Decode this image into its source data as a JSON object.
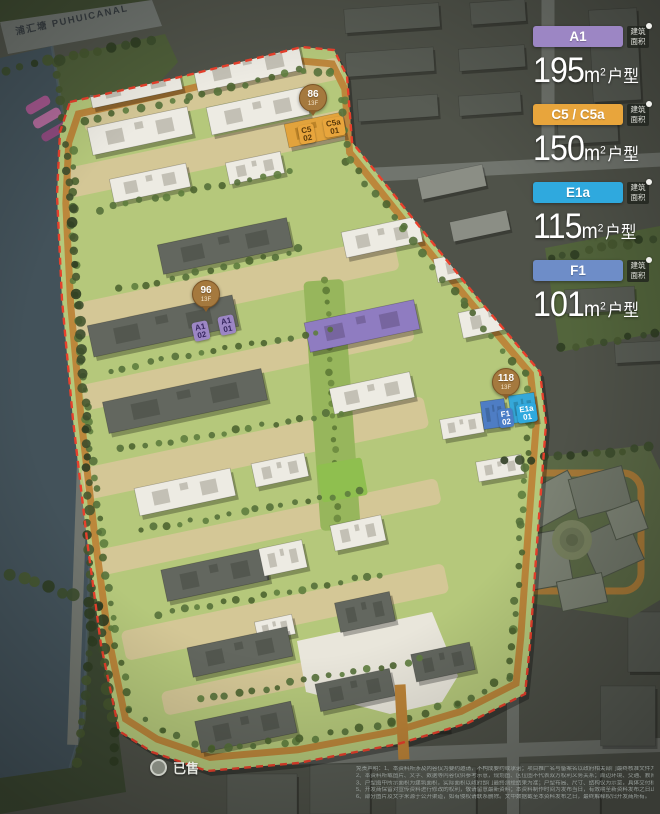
{
  "canal": {
    "label": "浦汇塘 PUHUICANAL"
  },
  "legend": {
    "area_badge_text": "建筑面积",
    "unit_m": "m",
    "unit_exp": "2",
    "unit_suffix": "户型",
    "entries": [
      {
        "code": "A1",
        "value": "195",
        "color": "#9c86c4"
      },
      {
        "code": "C5 / C5a",
        "value": "150",
        "color": "#e8a53c"
      },
      {
        "code": "E1a",
        "value": "115",
        "color": "#2fa9de"
      },
      {
        "code": "F1",
        "value": "101",
        "color": "#6e8dc8"
      }
    ]
  },
  "markers": [
    {
      "number": "86",
      "floor": "13F",
      "x": 313,
      "y": 100,
      "tags": [
        {
          "label": "C5",
          "num": "02",
          "x": 307,
          "y": 134,
          "rot": -10,
          "bg": "#e8a53c",
          "fg": "#59390a"
        },
        {
          "label": "C5a",
          "num": "01",
          "x": 334,
          "y": 127,
          "rot": -10,
          "bg": "#e8a53c",
          "fg": "#59390a"
        }
      ]
    },
    {
      "number": "96",
      "floor": "13F",
      "x": 206,
      "y": 296,
      "tags": [
        {
          "label": "A1",
          "num": "02",
          "x": 201,
          "y": 331,
          "rot": -12,
          "bg": "#9c86c4",
          "fg": "#35255e"
        },
        {
          "label": "A1",
          "num": "01",
          "x": 227,
          "y": 325,
          "rot": -12,
          "bg": "#9c86c4",
          "fg": "#35255e"
        }
      ]
    },
    {
      "number": "118",
      "floor": "13F",
      "x": 506,
      "y": 384,
      "tags": [
        {
          "label": "F1",
          "num": "02",
          "x": 506,
          "y": 418,
          "rot": -8,
          "bg": "#4a7dc6",
          "fg": "#ffffff"
        },
        {
          "label": "E1a",
          "num": "01",
          "x": 527,
          "y": 413,
          "rot": -8,
          "bg": "#2fa9de",
          "fg": "#ffffff"
        }
      ]
    }
  ],
  "sold": {
    "label": "已售"
  },
  "disclaimer": {
    "lines": [
      "免责声明：1、本资料所涉及内容仅为要约邀请，不构成要约或承诺；项目推广名与备案名以政府相关部门最终核准文件为准，买卖双方权利义务以双方签署的《商品房预售合同》及附件等协议为准。",
      "2、本资料所载图片、文字、数据等内容仅供参考示意，规划图、区位图不代表双方权利义务关系；周边环境、交通、教育、商业等配套信息仅作参考，不作为开发商的承诺或保证，敬请留意。",
      "3、户型图中所示面积为建筑面积，实际面积以政府部门最终测绘结果为准；户型布局、尺寸、结构仅为示意，具体交付标准以合同约定为准。4、本资料对项目周边环境的介绍旨在提供相关信息，不代表对此作出承诺。",
      "5、开发商保留对宣传资料进行修改的权利，敬请留意最新资料；本资料制作时间为发布当日，有效期至新资料发布之日止；相关内容不排除因政府规划、规定及开发商未能控制的原因而发生变化。",
      "6、部分图片及文字来源于公开渠道，如有侵权请联系删除。文中数据截至本资料发布之日，最终解释权归开发商所有。"
    ]
  },
  "map": {
    "bg": "#4f5249",
    "canal": {
      "pts": [
        [
          0,
          58
        ],
        [
          52,
          46
        ],
        [
          70,
          160
        ],
        [
          82,
          330
        ],
        [
          90,
          560
        ],
        [
          84,
          720
        ],
        [
          70,
          768
        ],
        [
          0,
          778
        ]
      ],
      "fill": "#43525a"
    },
    "top_road": {
      "pts": [
        [
          0,
          22
        ],
        [
          152,
          0
        ],
        [
          162,
          26
        ],
        [
          8,
          54
        ]
      ],
      "fill": "#6e736e"
    },
    "roads": [
      {
        "x": 500,
        "y": 168,
        "w": 330,
        "h": 14,
        "rot": -3
      },
      {
        "x": 548,
        "y": 82,
        "w": 13,
        "h": 172,
        "rot": 0
      },
      {
        "x": 430,
        "y": 753,
        "w": 470,
        "h": 14,
        "rot": -2
      },
      {
        "x": 513,
        "y": 722,
        "w": 12,
        "h": 190,
        "rot": 0
      },
      {
        "x": 84,
        "y": 420,
        "w": 11,
        "h": 650,
        "rot": 2
      }
    ],
    "road_fill": "#71756e",
    "greens": [
      {
        "pts": [
          [
            0,
            0
          ],
          [
            150,
            0
          ],
          [
            0,
            24
          ]
        ],
        "fill": "#3e4a31"
      },
      {
        "pts": [
          [
            40,
            62
          ],
          [
            165,
            34
          ],
          [
            178,
            62
          ],
          [
            96,
            152
          ],
          [
            56,
            152
          ]
        ],
        "fill": "#4e5e39"
      },
      {
        "pts": [
          [
            0,
            540
          ],
          [
            96,
            562
          ],
          [
            126,
            792
          ],
          [
            0,
            814
          ]
        ],
        "fill": "#3c4832"
      },
      {
        "pts": [
          [
            545,
            248
          ],
          [
            660,
            226
          ],
          [
            660,
            332
          ],
          [
            560,
            352
          ]
        ],
        "fill": "#53653c"
      }
    ],
    "pink_beds": [
      {
        "x": 38,
        "y": 105,
        "w": 26,
        "h": 10,
        "rot": -30,
        "fill": "#a2568c"
      },
      {
        "x": 47,
        "y": 118,
        "w": 30,
        "h": 10,
        "rot": -30,
        "fill": "#b06a9a"
      },
      {
        "x": 56,
        "y": 131,
        "w": 32,
        "h": 9,
        "rot": -30,
        "fill": "#8e4a7e"
      }
    ],
    "blocks_fill": "#585c54",
    "blocks": [
      {
        "x": 392,
        "y": 18,
        "w": 95,
        "h": 24,
        "rot": -4
      },
      {
        "x": 498,
        "y": 12,
        "w": 55,
        "h": 22,
        "rot": -4
      },
      {
        "x": 390,
        "y": 62,
        "w": 88,
        "h": 24,
        "rot": -4
      },
      {
        "x": 492,
        "y": 58,
        "w": 66,
        "h": 22,
        "rot": -4
      },
      {
        "x": 615,
        "y": 55,
        "w": 48,
        "h": 92,
        "rot": -3
      },
      {
        "x": 398,
        "y": 108,
        "w": 80,
        "h": 22,
        "rot": -4
      },
      {
        "x": 490,
        "y": 104,
        "w": 62,
        "h": 20,
        "rot": -4
      },
      {
        "x": 588,
        "y": 132,
        "w": 60,
        "h": 22,
        "rot": -3
      },
      {
        "x": 452,
        "y": 182,
        "w": 66,
        "h": 22,
        "rot": -12,
        "fill": "#8b8e85"
      },
      {
        "x": 480,
        "y": 226,
        "w": 58,
        "h": 20,
        "rot": -12,
        "fill": "#8b8e85"
      },
      {
        "x": 600,
        "y": 300,
        "w": 70,
        "h": 24,
        "rot": -3
      },
      {
        "x": 640,
        "y": 352,
        "w": 50,
        "h": 20,
        "rot": -3
      },
      {
        "x": 262,
        "y": 795,
        "w": 70,
        "h": 42,
        "rot": 0
      },
      {
        "x": 340,
        "y": 789,
        "w": 60,
        "h": 50,
        "rot": 0
      },
      {
        "x": 436,
        "y": 791,
        "w": 80,
        "h": 48,
        "rot": 0
      },
      {
        "x": 560,
        "y": 789,
        "w": 80,
        "h": 52,
        "rot": 0
      },
      {
        "x": 628,
        "y": 716,
        "w": 55,
        "h": 60,
        "rot": 0
      },
      {
        "x": 648,
        "y": 642,
        "w": 40,
        "h": 60,
        "rot": 0
      },
      {
        "x": 320,
        "y": 714,
        "w": 60,
        "h": 40,
        "rot": -2,
        "fill": "#5e625a"
      },
      {
        "x": 424,
        "y": 714,
        "w": 50,
        "h": 36,
        "rot": -2,
        "fill": "#5e625a"
      }
    ],
    "commercial": {
      "bg": {
        "pts": [
          [
            497,
            462
          ],
          [
            648,
            445
          ],
          [
            660,
            470
          ],
          [
            660,
            600
          ],
          [
            630,
            618
          ],
          [
            508,
            600
          ],
          [
            492,
            520
          ]
        ],
        "fill": "#5a6845"
      },
      "ring": {
        "x": 578,
        "y": 532,
        "w": 126,
        "h": 118,
        "stroke": "#ad7a35",
        "sw": 7
      },
      "roofs_fill": "#7b8173",
      "roofs": [
        {
          "x": 552,
          "y": 500,
          "w": 55,
          "h": 38,
          "rot": -28
        },
        {
          "x": 600,
          "y": 492,
          "w": 55,
          "h": 40,
          "rot": -15,
          "fill": "#6f7568"
        },
        {
          "x": 545,
          "y": 560,
          "w": 48,
          "h": 55,
          "rot": -10
        },
        {
          "x": 612,
          "y": 548,
          "w": 50,
          "h": 46,
          "rot": -24,
          "fill": "#6f7568"
        },
        {
          "x": 582,
          "y": 592,
          "w": 46,
          "h": 30,
          "rot": -12
        },
        {
          "x": 627,
          "y": 520,
          "w": 34,
          "h": 30,
          "rot": -20
        }
      ],
      "court": {
        "cx": 572,
        "cy": 540,
        "r": 20
      }
    },
    "parcel": {
      "outer": [
        [
          70,
          102
        ],
        [
          180,
          77
        ],
        [
          302,
          47
        ],
        [
          334,
          50
        ],
        [
          347,
          76
        ],
        [
          352,
          142
        ],
        [
          410,
          215
        ],
        [
          475,
          295
        ],
        [
          540,
          372
        ],
        [
          546,
          424
        ],
        [
          538,
          530
        ],
        [
          530,
          645
        ],
        [
          525,
          694
        ],
        [
          468,
          723
        ],
        [
          398,
          744
        ],
        [
          298,
          763
        ],
        [
          207,
          771
        ],
        [
          152,
          752
        ],
        [
          119,
          731
        ],
        [
          101,
          645
        ],
        [
          87,
          540
        ],
        [
          73,
          420
        ],
        [
          62,
          300
        ],
        [
          57,
          195
        ],
        [
          60,
          132
        ]
      ],
      "fill": "#b5c87b",
      "ring_stroke": "#bd8438",
      "boundary_stroke": "#e8402c",
      "tan_fill": "#d4c796",
      "tans": [
        {
          "x": 212,
          "y": 95,
          "w": 262,
          "h": 22,
          "rot": -12
        },
        {
          "x": 215,
          "y": 152,
          "w": 300,
          "h": 30,
          "rot": -12
        },
        {
          "x": 235,
          "y": 287,
          "w": 330,
          "h": 34,
          "rot": -12
        },
        {
          "x": 248,
          "y": 363,
          "w": 336,
          "h": 26,
          "rot": -12
        },
        {
          "x": 255,
          "y": 448,
          "w": 350,
          "h": 32,
          "rot": -12
        },
        {
          "x": 268,
          "y": 527,
          "w": 350,
          "h": 26,
          "rot": -12
        },
        {
          "x": 285,
          "y": 612,
          "w": 330,
          "h": 30,
          "rot": -12
        },
        {
          "x": 300,
          "y": 675,
          "w": 280,
          "h": 24,
          "rot": -12
        }
      ],
      "axis": {
        "x": 332,
        "y": 405,
        "w": 40,
        "h": 250,
        "rot": -4,
        "fill": "#97b65c"
      },
      "field": {
        "x": 342,
        "y": 480,
        "w": 46,
        "h": 38,
        "rot": -10,
        "fill": "#8fbf4f"
      },
      "plaza": {
        "pts": [
          [
            297,
            641
          ],
          [
            432,
            612
          ],
          [
            458,
            676
          ],
          [
            442,
            702
          ],
          [
            390,
            714
          ],
          [
            306,
            692
          ]
        ],
        "fill": "#e9e6db"
      },
      "entrance": {
        "x": 402,
        "y": 722,
        "w": 11,
        "h": 75,
        "rot": -3,
        "fill": "#bd8438"
      }
    },
    "building_colors": {
      "w": "#edebe3",
      "g": "#63675f",
      "p": "#8f7cc1",
      "o": "#e2a33c",
      "c": "#35a8d9",
      "b": "#4e7dc4"
    },
    "building_detail": {
      "w": "#c3c0b5",
      "g": "#53574f",
      "p": "#77659f",
      "o": "#bd8428",
      "c": "#2b8cb4",
      "b": "#4069a3"
    },
    "buildings": [
      {
        "x": 135,
        "y": 86,
        "w": 92,
        "h": 26,
        "rot": -12,
        "t": "w"
      },
      {
        "x": 248,
        "y": 67,
        "w": 108,
        "h": 28,
        "rot": -12,
        "t": "w"
      },
      {
        "x": 140,
        "y": 131,
        "w": 102,
        "h": 28,
        "rot": -12,
        "t": "w"
      },
      {
        "x": 258,
        "y": 111,
        "w": 100,
        "h": 28,
        "rot": -12,
        "t": "w"
      },
      {
        "x": 315,
        "y": 130,
        "w": 58,
        "h": 24,
        "rot": -12,
        "t": "o"
      },
      {
        "x": 150,
        "y": 183,
        "w": 78,
        "h": 24,
        "rot": -12,
        "t": "w"
      },
      {
        "x": 255,
        "y": 168,
        "w": 56,
        "h": 22,
        "rot": -12,
        "t": "w"
      },
      {
        "x": 225,
        "y": 246,
        "w": 132,
        "h": 30,
        "rot": -12,
        "t": "g"
      },
      {
        "x": 382,
        "y": 237,
        "w": 78,
        "h": 26,
        "rot": -12,
        "t": "w"
      },
      {
        "x": 468,
        "y": 264,
        "w": 66,
        "h": 24,
        "rot": -12,
        "t": "w"
      },
      {
        "x": 163,
        "y": 326,
        "w": 148,
        "h": 32,
        "rot": -12,
        "t": "g"
      },
      {
        "x": 362,
        "y": 326,
        "w": 112,
        "h": 30,
        "rot": -12,
        "t": "p"
      },
      {
        "x": 492,
        "y": 319,
        "w": 64,
        "h": 26,
        "rot": -12,
        "t": "w"
      },
      {
        "x": 185,
        "y": 401,
        "w": 162,
        "h": 32,
        "rot": -12,
        "t": "g"
      },
      {
        "x": 372,
        "y": 393,
        "w": 82,
        "h": 26,
        "rot": -12,
        "t": "w"
      },
      {
        "x": 462,
        "y": 426,
        "w": 42,
        "h": 20,
        "rot": -10,
        "t": "w"
      },
      {
        "x": 494,
        "y": 414,
        "w": 24,
        "h": 28,
        "rot": -8,
        "t": "b"
      },
      {
        "x": 523,
        "y": 408,
        "w": 26,
        "h": 28,
        "rot": -8,
        "t": "c"
      },
      {
        "x": 500,
        "y": 468,
        "w": 46,
        "h": 20,
        "rot": -10,
        "t": "w"
      },
      {
        "x": 185,
        "y": 492,
        "w": 98,
        "h": 28,
        "rot": -12,
        "t": "w"
      },
      {
        "x": 280,
        "y": 470,
        "w": 54,
        "h": 24,
        "rot": -12,
        "t": "w"
      },
      {
        "x": 215,
        "y": 575,
        "w": 104,
        "h": 32,
        "rot": -12,
        "t": "g"
      },
      {
        "x": 283,
        "y": 558,
        "w": 44,
        "h": 28,
        "rot": -12,
        "t": "w"
      },
      {
        "x": 358,
        "y": 533,
        "w": 52,
        "h": 26,
        "rot": -12,
        "t": "w"
      },
      {
        "x": 365,
        "y": 612,
        "w": 56,
        "h": 30,
        "rot": -12,
        "t": "g"
      },
      {
        "x": 275,
        "y": 628,
        "w": 38,
        "h": 20,
        "rot": -12,
        "t": "w"
      },
      {
        "x": 240,
        "y": 652,
        "w": 102,
        "h": 30,
        "rot": -12,
        "t": "g"
      },
      {
        "x": 355,
        "y": 690,
        "w": 76,
        "h": 28,
        "rot": -12,
        "t": "g"
      },
      {
        "x": 246,
        "y": 727,
        "w": 98,
        "h": 32,
        "rot": -12,
        "t": "g"
      },
      {
        "x": 443,
        "y": 662,
        "w": 60,
        "h": 28,
        "rot": -12,
        "t": "g"
      }
    ],
    "tree_rows": [
      {
        "pts": [
          [
            56,
            62
          ],
          [
            72,
            210
          ],
          [
            86,
            430
          ],
          [
            92,
            640
          ],
          [
            78,
            762
          ]
        ],
        "sp": 13,
        "r": 4.2,
        "dark": true
      },
      {
        "pts": [
          [
            8,
            70
          ],
          [
            150,
            40
          ]
        ],
        "sp": 13,
        "r": 4.5,
        "dark": true
      },
      {
        "pts": [
          [
            550,
            258
          ],
          [
            652,
            238
          ]
        ],
        "sp": 12,
        "r": 4,
        "dark": true
      },
      {
        "pts": [
          [
            562,
            348
          ],
          [
            656,
            334
          ]
        ],
        "sp": 12,
        "r": 4,
        "dark": true
      },
      {
        "pts": [
          [
            10,
            575
          ],
          [
            100,
            605
          ],
          [
            116,
            760
          ]
        ],
        "sp": 13,
        "r": 5,
        "dark": true
      },
      {
        "pts": [
          [
            505,
            462
          ],
          [
            648,
            448
          ]
        ],
        "sp": 13,
        "r": 4,
        "dark": true
      },
      {
        "pts": [
          [
            100,
            210
          ],
          [
            290,
            170
          ]
        ],
        "sp": 13,
        "r": 3.2
      },
      {
        "pts": [
          [
            120,
            290
          ],
          [
            300,
            250
          ]
        ],
        "sp": 13,
        "r": 3.2
      },
      {
        "pts": [
          [
            110,
            370
          ],
          [
            330,
            330
          ]
        ],
        "sp": 13,
        "r": 3.2
      },
      {
        "pts": [
          [
            120,
            450
          ],
          [
            340,
            412
          ]
        ],
        "sp": 13,
        "r": 3.2
      },
      {
        "pts": [
          [
            140,
            530
          ],
          [
            360,
            492
          ]
        ],
        "sp": 13,
        "r": 3.2
      },
      {
        "pts": [
          [
            160,
            615
          ],
          [
            380,
            575
          ]
        ],
        "sp": 13,
        "r": 3.2
      },
      {
        "pts": [
          [
            200,
            700
          ],
          [
            420,
            660
          ]
        ],
        "sp": 13,
        "r": 3.2
      }
    ]
  }
}
